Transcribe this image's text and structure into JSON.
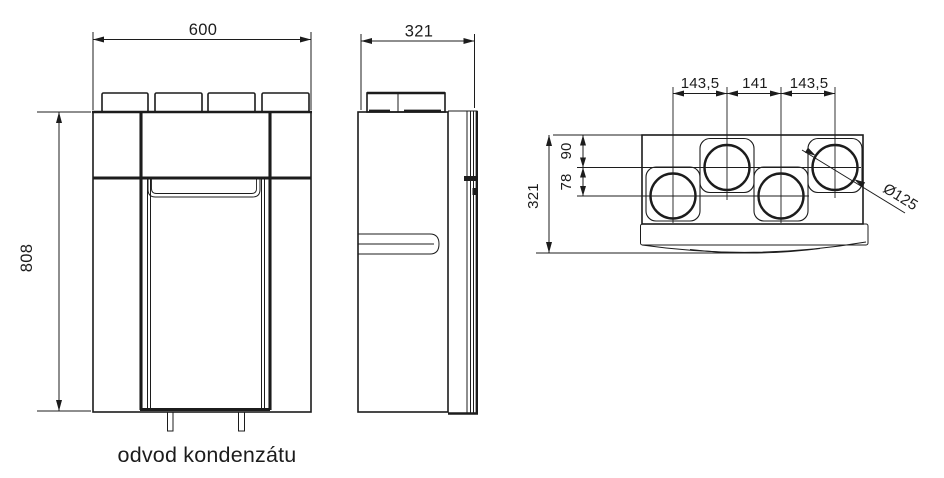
{
  "colors": {
    "line": "#1c1c1c",
    "background": "#ffffff"
  },
  "front_view": {
    "width_label": "600",
    "height_label": "808",
    "caption": "odvod kondenzátu"
  },
  "side_view": {
    "depth_label": "321"
  },
  "top_view": {
    "spacing_labels": [
      "143,5",
      "141",
      "143,5"
    ],
    "depth_label": "321",
    "offset_top_label": "90",
    "offset_mid_label": "78",
    "port_diameter_label": "Ø125"
  }
}
